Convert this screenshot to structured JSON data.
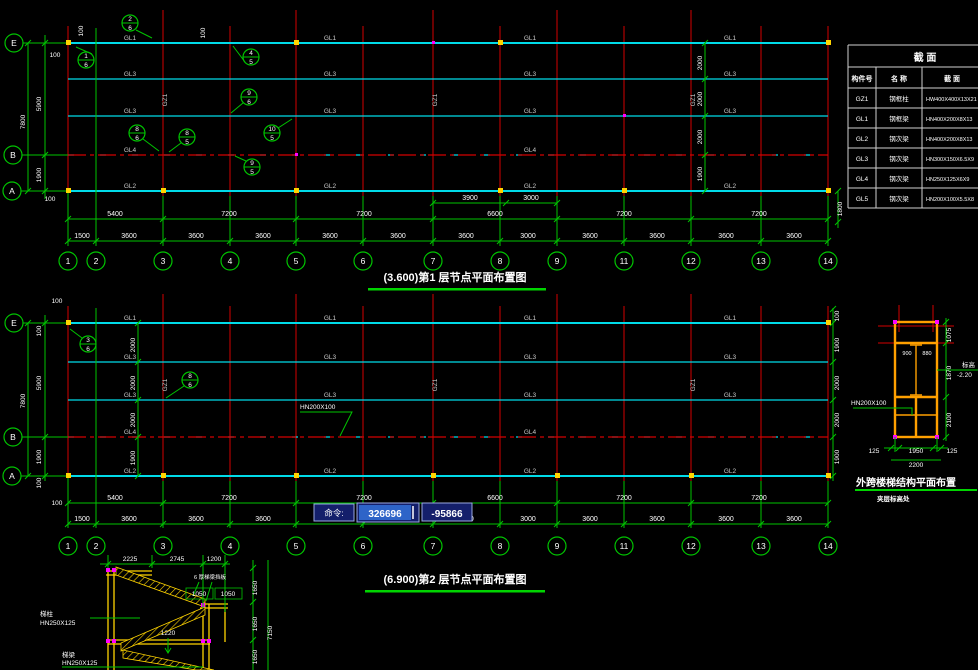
{
  "command_bar": {
    "label": "命令:",
    "value": "326696",
    "value2": "-95866"
  },
  "plan1": {
    "title": "(3.600)第1 层节点平面布置图",
    "rows": [
      "E",
      "B",
      "A"
    ],
    "cols": [
      "1",
      "2",
      "3",
      "4",
      "5",
      "6",
      "7",
      "8",
      "9",
      "11",
      "12",
      "13",
      "14"
    ],
    "dims_sub": [
      "3900",
      "3000"
    ],
    "dims_span": [
      "5400",
      "7200",
      "7200",
      "6600",
      "7200",
      "7200"
    ],
    "dims_bay": [
      "1500",
      "3600",
      "3600",
      "3600",
      "3600",
      "3600",
      "3600",
      "3000",
      "3600",
      "3600",
      "3600",
      "3600"
    ],
    "dims_left": [
      "100",
      "5900",
      "7800",
      "1900",
      "100"
    ],
    "dims_inner": [
      "2000",
      "2000",
      "2000",
      "1900"
    ],
    "dim_right": "1800",
    "off_top": "100",
    "off_top2": "100",
    "beams": {
      "top": "GL1",
      "mid": "GL3",
      "b_row": "GL4",
      "bottom": "GL2",
      "col": "GZ1"
    },
    "details": [
      {
        "n": "2",
        "d": "6"
      },
      {
        "n": "1",
        "d": "6"
      },
      {
        "n": "4",
        "d": "5"
      },
      {
        "n": "9",
        "d": "6"
      },
      {
        "n": "8",
        "d": "6"
      },
      {
        "n": "8",
        "d": "5"
      },
      {
        "n": "10",
        "d": "5"
      },
      {
        "n": "9",
        "d": "5"
      }
    ]
  },
  "plan2": {
    "title": "(6.900)第2 层节点平面布置图",
    "rows": [
      "E",
      "B",
      "A"
    ],
    "cols": [
      "1",
      "2",
      "3",
      "4",
      "5",
      "6",
      "7",
      "8",
      "9",
      "11",
      "12",
      "13",
      "14"
    ],
    "dims_span": [
      "5400",
      "7200",
      "7200",
      "6600",
      "7200",
      "7200"
    ],
    "dims_bay": [
      "1500",
      "3600",
      "3600",
      "3600",
      "3600",
      "3600",
      "3600",
      "3000",
      "3600",
      "3600",
      "3600",
      "3600"
    ],
    "dims_left": [
      "100",
      "5900",
      "7800",
      "1900",
      "100"
    ],
    "off_top": "100",
    "off_bottom": "100",
    "dims_inner": [
      "2000",
      "2000",
      "2000",
      "1900"
    ],
    "dims_right": [
      "100",
      "1900",
      "2000",
      "2000",
      "1900"
    ],
    "beam_label": "HN200X100",
    "beams": {
      "top": "GL1",
      "mid": "GL3",
      "b_row": "GL4",
      "bottom": "GL2",
      "col": "GZ1"
    },
    "details": [
      {
        "n": "3",
        "d": "6"
      },
      {
        "n": "8",
        "d": "6"
      }
    ]
  },
  "table": {
    "title": "截  面",
    "headers": [
      "构件号",
      "名 称",
      "截 面"
    ],
    "rows": [
      {
        "id": "GZ1",
        "name": "钢框柱",
        "section": "HW400X400X13X21"
      },
      {
        "id": "GL1",
        "name": "钢框梁",
        "section": "HN400X200X8X13"
      },
      {
        "id": "GL2",
        "name": "钢次梁",
        "section": "HN400X200X8X13"
      },
      {
        "id": "GL3",
        "name": "钢次梁",
        "section": "HN300X150X6.5X9"
      },
      {
        "id": "GL4",
        "name": "钢次梁",
        "section": "HN250X125X6X9"
      },
      {
        "id": "GL5",
        "name": "钢次梁",
        "section": "HN200X100X5.5X8"
      }
    ]
  },
  "stair_plan": {
    "title": "外跨楼梯结构平面布置",
    "subtitle": "夹层标高处",
    "member_label": "HN200X100",
    "elev_label": "标高",
    "elev_value": "-2.20",
    "dims_right": [
      "1075",
      "1870",
      "2100"
    ],
    "dims_bottom": [
      "125",
      "1950",
      "125"
    ],
    "dim_total": "2200",
    "dims_inner": [
      "900",
      "880"
    ]
  },
  "stair_elev": {
    "dims_top": [
      "2225",
      "2745",
      "1200"
    ],
    "dims_mid": [
      "1050",
      "1050"
    ],
    "dim_drop": "1220",
    "note": "6 厚梯梁挡板",
    "dims_right": [
      "1650",
      "1650",
      "1650"
    ],
    "dim_total": "7150",
    "labels": [
      {
        "t": "梯柱",
        "s": "HN250X125"
      },
      {
        "t": "梯梁",
        "s": "HN250X125"
      }
    ]
  }
}
